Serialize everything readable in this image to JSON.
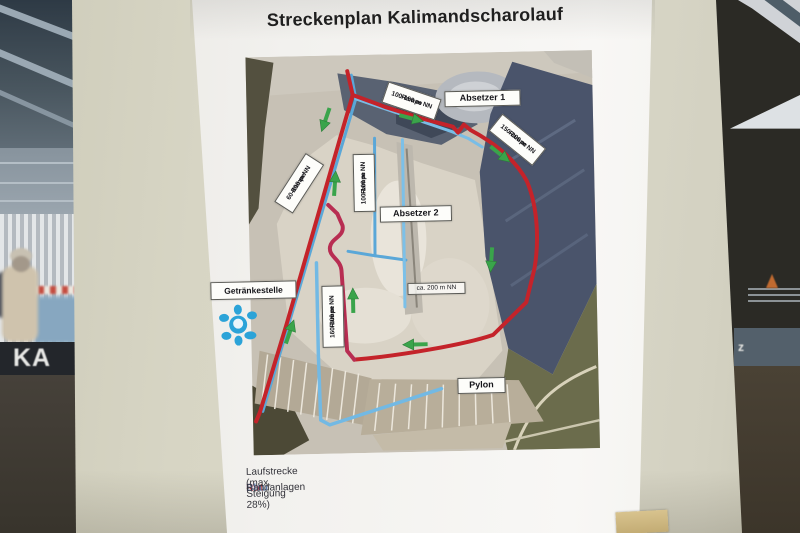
{
  "background": {
    "ka_sign": "KA",
    "sign_fragment": "z"
  },
  "poster": {
    "title": "Streckenplan Kalimandscharolauf",
    "map": {
      "labels": {
        "absetzer1": "Absetzer 1",
        "absetzer2": "Absetzer 2",
        "rampe_100_150": {
          "line1": "Rampe",
          "line2": "100-150 m NN"
        },
        "rampe_150_200": {
          "line1": "Rampe",
          "line2": "150-200 m NN"
        },
        "rampe_60_100": {
          "line1": "Rampe",
          "line2": "60-100 m NN"
        },
        "rampe_100_160": {
          "line1": "Rampe",
          "line2": "100-160 m NN"
        },
        "rampe_160_200": {
          "line1": "Rampe",
          "line2": "160-200 m NN"
        },
        "getraenkestelle": "Getränkestelle",
        "ca_200": "ca. 200 m NN",
        "pylon": "Pylon"
      }
    },
    "legend": {
      "rows": [
        {
          "term": "Rot",
          "separator": "-",
          "definition": "Laufstrecke (max. Steigung 28%)"
        },
        {
          "term": "Blau",
          "separator": "-",
          "definition": "Bandanlagen"
        }
      ]
    }
  },
  "colors": {
    "route_red": "#c4232a",
    "ramp_magenta": "#b82d52",
    "conveyor_blue": "#5aa7d8",
    "arrow_green": "#3aa44b",
    "legend_red": "#b51f24",
    "legend_blue": "#5f7aa8"
  }
}
